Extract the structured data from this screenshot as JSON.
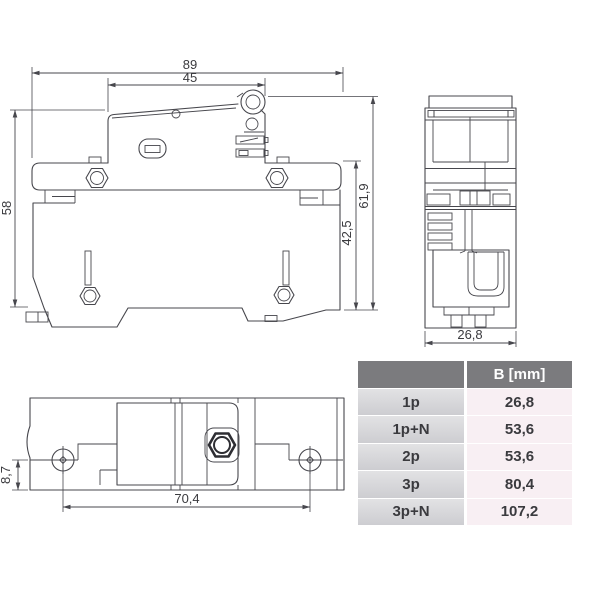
{
  "drawing": {
    "line_color": "#47474d",
    "side_view": {
      "dims": {
        "total_width": "89",
        "top_width": "45",
        "left_height": "58",
        "right_height": "61,9",
        "inner_height": "42,5"
      }
    },
    "front_view": {
      "dims": {
        "width": "26,8"
      }
    },
    "bottom_view": {
      "dims": {
        "screw_offset": "8,7",
        "screw_spacing": "70,4"
      }
    }
  },
  "table": {
    "header": {
      "col2": "B [mm]"
    },
    "rows": [
      {
        "label": "1p",
        "value": "26,8"
      },
      {
        "label": "1p+N",
        "value": "53,6"
      },
      {
        "label": "2p",
        "value": "53,6"
      },
      {
        "label": "3p",
        "value": "80,4"
      },
      {
        "label": "3p+N",
        "value": "107,2"
      }
    ],
    "colors": {
      "header_bg": "#7b7b7e",
      "header_text": "#ffffff",
      "label_bg": "#d6d6d9",
      "value_bg": "#f8eff3",
      "text": "#3a3a3e"
    }
  }
}
